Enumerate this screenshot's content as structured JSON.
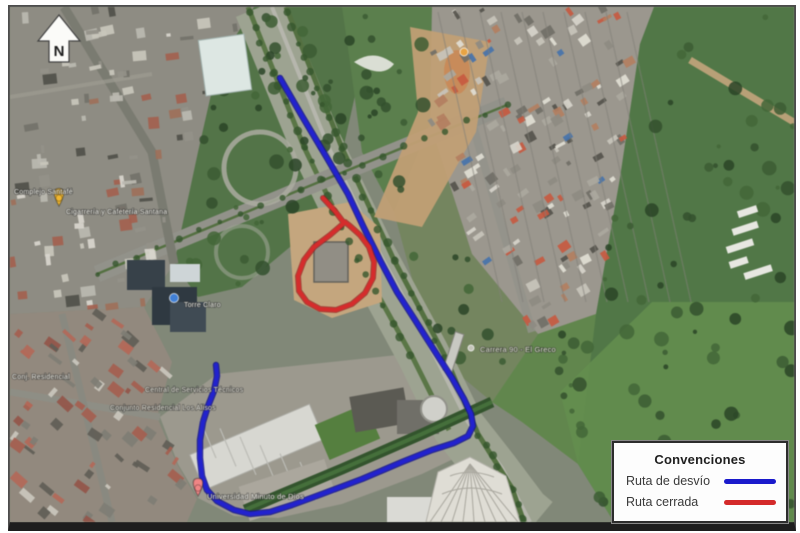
{
  "figure": {
    "type": "satellite-detour-map"
  },
  "north": {
    "label": "N"
  },
  "legend": {
    "title": "Convenciones",
    "items": [
      {
        "label": "Ruta de desvío",
        "color": "#1a1acc"
      },
      {
        "label": "Ruta cerrada",
        "color": "#d42a2a"
      }
    ]
  },
  "map": {
    "routes": {
      "detour": {
        "name": "Ruta de desvío",
        "color": "#1a1acc",
        "points": [
          [
            278,
            76
          ],
          [
            300,
            114
          ],
          [
            325,
            156
          ],
          [
            346,
            192
          ],
          [
            362,
            226
          ],
          [
            378,
            258
          ],
          [
            395,
            290
          ],
          [
            413,
            318
          ],
          [
            432,
            348
          ],
          [
            450,
            376
          ],
          [
            462,
            397
          ],
          [
            469,
            412
          ],
          [
            471,
            424
          ],
          [
            466,
            434
          ],
          [
            452,
            441
          ],
          [
            430,
            448
          ],
          [
            400,
            460
          ],
          [
            360,
            477
          ],
          [
            320,
            492
          ],
          [
            290,
            503
          ],
          [
            268,
            510
          ],
          [
            248,
            512
          ],
          [
            232,
            508
          ],
          [
            215,
            499
          ],
          [
            205,
            488
          ],
          [
            200,
            474
          ],
          [
            198,
            456
          ],
          [
            198,
            438
          ],
          [
            201,
            420
          ],
          [
            206,
            404
          ],
          [
            212,
            389
          ],
          [
            215,
            374
          ],
          [
            214,
            363
          ]
        ]
      },
      "closed": {
        "name": "Ruta cerrada",
        "color": "#d42424",
        "points": [
          [
            321,
            196
          ],
          [
            333,
            209
          ],
          [
            342,
            221
          ],
          [
            328,
            233
          ],
          [
            312,
            245
          ],
          [
            302,
            258
          ],
          [
            296,
            274
          ],
          [
            297,
            289
          ],
          [
            305,
            300
          ],
          [
            318,
            307
          ],
          [
            334,
            308
          ],
          [
            350,
            302
          ],
          [
            363,
            291
          ],
          [
            371,
            276
          ],
          [
            372,
            260
          ],
          [
            367,
            245
          ],
          [
            358,
            233
          ],
          [
            348,
            224
          ],
          [
            343,
            220
          ]
        ]
      }
    },
    "labels": [
      {
        "text": "Complejo Santafé",
        "x": 12,
        "y": 192,
        "size": 7,
        "color": "#e9e9e1"
      },
      {
        "text": "Cigarrería y Cafetería Santana",
        "x": 64,
        "y": 212,
        "size": 7,
        "color": "#e9e9e1"
      },
      {
        "text": "Torre Claro",
        "x": 182,
        "y": 305,
        "size": 7,
        "color": "#e4e4dc"
      },
      {
        "text": "Conj. Residencial",
        "x": 10,
        "y": 377,
        "size": 7,
        "color": "#e4e4dc"
      },
      {
        "text": "Carrera 90 - El Greco",
        "x": 478,
        "y": 350,
        "size": 7.5,
        "color": "#d8d8cc"
      },
      {
        "text": "Central de Servicios Técnicos",
        "x": 143,
        "y": 390,
        "size": 7,
        "color": "#dedcd2"
      },
      {
        "text": "Conjunto Residencial Los Alisos",
        "x": 108,
        "y": 408,
        "size": 7,
        "color": "#dedcd2"
      },
      {
        "text": "Universidad Minuto de Dios",
        "x": 205,
        "y": 497,
        "size": 7.5,
        "color": "#e6e6de"
      }
    ],
    "markers": [
      {
        "kind": "pin",
        "color": "#f0b429",
        "x": 57,
        "y": 204
      },
      {
        "kind": "dot",
        "color": "#e8a13c",
        "x": 462,
        "y": 50,
        "r": 4
      },
      {
        "kind": "dot",
        "color": "#3a7bd5",
        "x": 172,
        "y": 296,
        "r": 4.5
      },
      {
        "kind": "pin",
        "color": "#ef8080",
        "x": 196,
        "y": 494
      },
      {
        "kind": "dot",
        "color": "#c2c2b8",
        "x": 469,
        "y": 346,
        "r": 3
      }
    ]
  }
}
